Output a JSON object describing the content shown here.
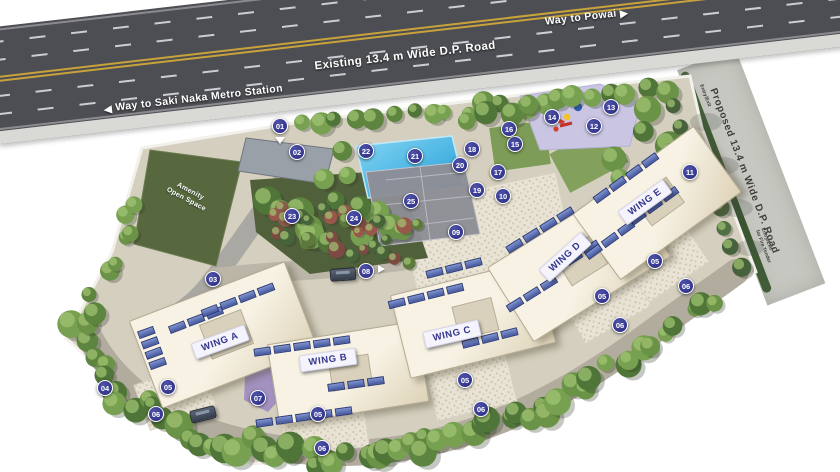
{
  "roads": {
    "existing_label": "Existing 13.4 m Wide D.P. Road",
    "powai_label": "Way to Powai",
    "powai_arrow": "▶",
    "saki_label": "Way to Saki Naka Metro Station",
    "saki_arrow": "◀",
    "proposed_label": "Proposed 13.4 m Wide D.P. Road",
    "entry_exit_top_label": "Entry/Exit",
    "entry_exit_bottom_label": "Entry/Exit\nfor Fire Tender"
  },
  "site": {
    "amenity_open_space_label": "Amenity\nOpen Space",
    "wings": [
      {
        "id": "a",
        "label": "WING A"
      },
      {
        "id": "b",
        "label": "WING B"
      },
      {
        "id": "c",
        "label": "WING C"
      },
      {
        "id": "d",
        "label": "WING D"
      },
      {
        "id": "e",
        "label": "WING E"
      }
    ]
  },
  "markers": [
    {
      "n": "01",
      "x": 280,
      "y": 126,
      "arrow": "down"
    },
    {
      "n": "02",
      "x": 297,
      "y": 152
    },
    {
      "n": "03",
      "x": 213,
      "y": 279
    },
    {
      "n": "04",
      "x": 105,
      "y": 388
    },
    {
      "n": "05",
      "x": 168,
      "y": 387
    },
    {
      "n": "06",
      "x": 156,
      "y": 414
    },
    {
      "n": "07",
      "x": 258,
      "y": 398
    },
    {
      "n": "05",
      "x": 318,
      "y": 414
    },
    {
      "n": "06",
      "x": 322,
      "y": 448
    },
    {
      "n": "05",
      "x": 465,
      "y": 380
    },
    {
      "n": "06",
      "x": 481,
      "y": 409
    },
    {
      "n": "05",
      "x": 602,
      "y": 296
    },
    {
      "n": "06",
      "x": 620,
      "y": 325
    },
    {
      "n": "05",
      "x": 655,
      "y": 261
    },
    {
      "n": "06",
      "x": 686,
      "y": 286
    },
    {
      "n": "08",
      "x": 366,
      "y": 271,
      "arrow": "right"
    },
    {
      "n": "09",
      "x": 456,
      "y": 232
    },
    {
      "n": "10",
      "x": 503,
      "y": 196
    },
    {
      "n": "11",
      "x": 690,
      "y": 172
    },
    {
      "n": "12",
      "x": 594,
      "y": 126
    },
    {
      "n": "13",
      "x": 611,
      "y": 107
    },
    {
      "n": "14",
      "x": 552,
      "y": 117
    },
    {
      "n": "15",
      "x": 515,
      "y": 144
    },
    {
      "n": "16",
      "x": 509,
      "y": 129
    },
    {
      "n": "17",
      "x": 498,
      "y": 172
    },
    {
      "n": "18",
      "x": 472,
      "y": 149
    },
    {
      "n": "19",
      "x": 477,
      "y": 190
    },
    {
      "n": "20",
      "x": 460,
      "y": 165
    },
    {
      "n": "21",
      "x": 415,
      "y": 156
    },
    {
      "n": "22",
      "x": 366,
      "y": 151
    },
    {
      "n": "23",
      "x": 292,
      "y": 216
    },
    {
      "n": "24",
      "x": 354,
      "y": 218
    },
    {
      "n": "25",
      "x": 411,
      "y": 201
    }
  ],
  "colors": {
    "road_asphalt": "#4d4e53",
    "road_text": "#ffffff",
    "lane_yellow": "#c8a23a",
    "sidewalk": "#d9d9d5",
    "proposed_road": "#c7c7c1",
    "proposed_road_text": "#3e3e3e",
    "site_ground": "#d5cfbf",
    "driveway": "#b2ac9e",
    "lawn_dark": "#57683f",
    "pool_blue": "#35abe0",
    "court_gray": "#8e8e96",
    "playground_purple": "#c9c5e3",
    "marker_fill": "#34378c",
    "marker_text": "#ffffff",
    "badge_bg": "#f5f3fc",
    "badge_text": "#33368a",
    "panel_blue": "#5873bd",
    "tree_green": "#6b9347"
  }
}
